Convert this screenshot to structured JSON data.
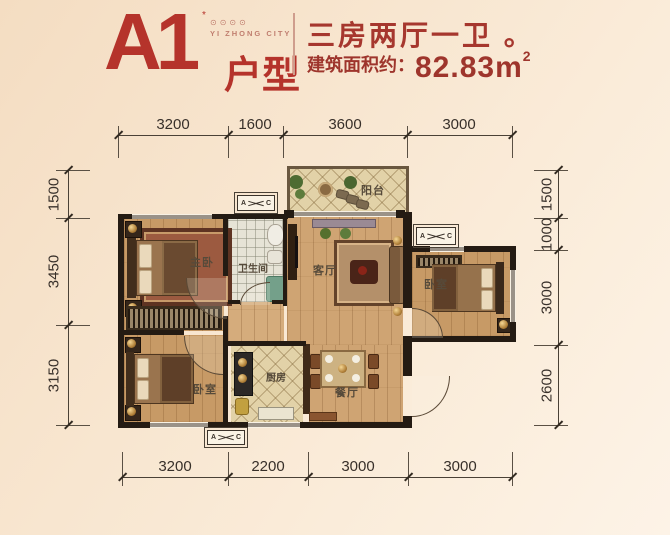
{
  "header": {
    "unit_code": "A1",
    "unit_suffix": "户型",
    "trademark_mark": "*",
    "logo_marks": "⊙⊙⊙⊙",
    "logo_text": "YI ZHONG CITY",
    "subtitle": "三房两厅一卫 。",
    "area_label": "建筑面积约：",
    "area_value": "82.83m",
    "area_sup": "2"
  },
  "colors": {
    "accent_red": "#b5332b",
    "subtitle_red": "#a6372e",
    "dim_line": "#3b332b",
    "wall": "#241b13",
    "wood_floor": "#cfa473",
    "tile_floor": "#e2d2a8"
  },
  "dimensions": {
    "top": [
      "3200",
      "1600",
      "3600",
      "3000"
    ],
    "bottom": [
      "3200",
      "2200",
      "3000",
      "3000"
    ],
    "left": [
      "1500",
      "3450",
      "3150"
    ],
    "right": [
      "1500",
      "1000",
      "3000",
      "2600"
    ]
  },
  "rooms": {
    "master_bedroom": "主卧",
    "bathroom": "卫生间",
    "living_room": "客厅",
    "balcony": "阳台",
    "bedroom_right": "卧室",
    "bedroom_second": "卧室",
    "kitchen": "厨房",
    "dining_room": "餐厅"
  },
  "ac_unit": {
    "left_letter": "A",
    "right_letter": "C"
  }
}
